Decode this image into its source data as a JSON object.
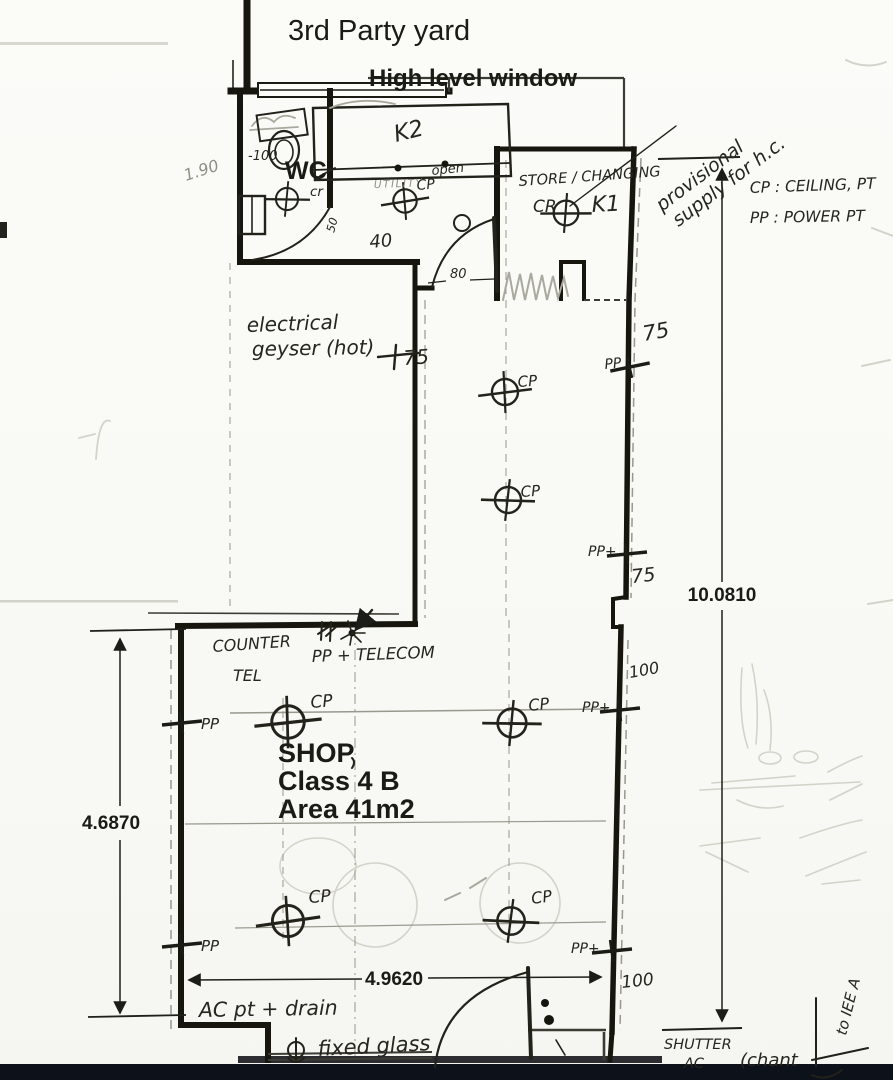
{
  "colors": {
    "paper": "#fafaf7",
    "ink": "#1b1b16",
    "pencil": "#8f8f86",
    "scan_bar": "#0d1119"
  },
  "header": {
    "yard": "3rd Party yard",
    "window": "High level window"
  },
  "legend": {
    "cp": "CP : CEILING, PT",
    "pp": "PP : POWER PT"
  },
  "rooms": {
    "wc": "WC",
    "store": "STORE / CHANGING",
    "k1": "K1",
    "k2": "K2",
    "utility": "UTILITY",
    "shop_name": "SHOP",
    "shop_class": "Class 4 B",
    "shop_area": "Area 41m2",
    "cr": "CR",
    "cr_small": "cr"
  },
  "notes": {
    "provisional_line1": "provisional",
    "provisional_line2": "supply for h.c.",
    "geyser_line1": "electrical",
    "geyser_line2": "geyser (hot)",
    "counter": "COUNTER",
    "tel": "TEL",
    "pp_telecom": "PP + TELECOM",
    "open": "open",
    "ac_drain": "AC pt + drain",
    "fixed_glass": "fixed glass",
    "shutter_line1": "SHUTTER",
    "shutter_line2": "AC",
    "chant": "(chant",
    "iee": "to IEE A"
  },
  "dims": {
    "right_total": "10.0810",
    "left_total": "4.6870",
    "bottom_total": "4.9620",
    "d75": "75",
    "d100": "100",
    "d80": "80",
    "d50": "50",
    "d40": "40",
    "d190": "1.90",
    "dneg100": "-100"
  },
  "markers": {
    "cp": "CP",
    "pp": "PP",
    "pp_plus": "PP+"
  }
}
